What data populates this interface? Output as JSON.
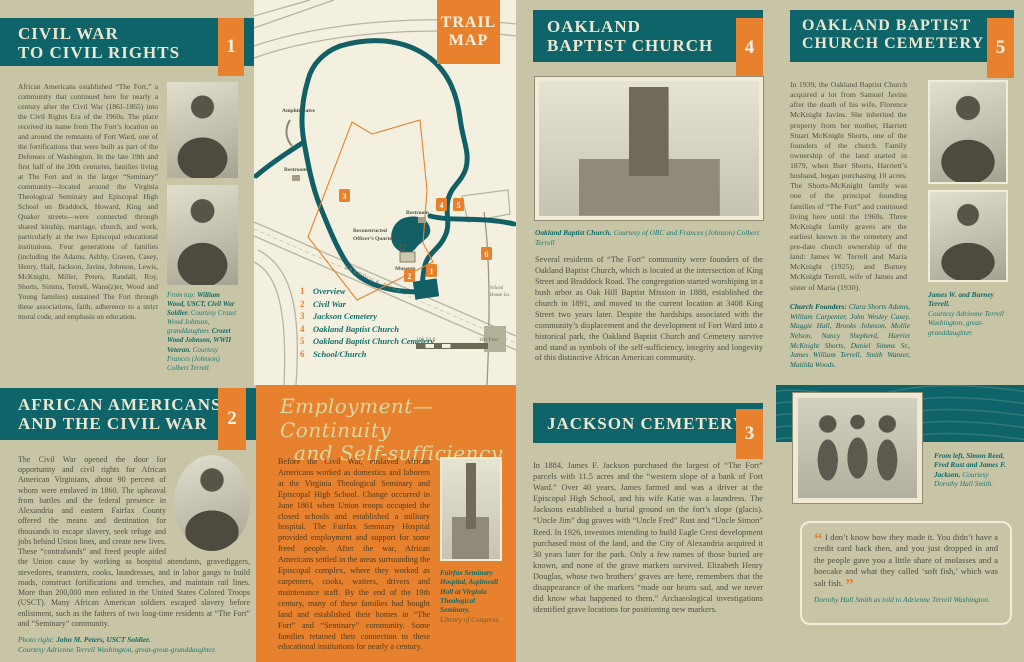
{
  "colors": {
    "teal": "#0e6468",
    "orange": "#e8812e",
    "olive": "#c8c5a6",
    "cream": "#f4f0e0"
  },
  "panel1": {
    "title1": "CIVIL WAR",
    "title2": "TO CIVIL RIGHTS",
    "number": "1",
    "body": "African Americans established “The Fort,” a community that continued here for nearly a century after the Civil War (1861-1865) into the Civil Rights Era of the 1960s. The place received its name from The Fort’s location on and around the remnants of Fort Ward, one of the fortifications that were built as part of the Defenses of Washington. In the late 19th and first half of the 20th centuries, families living at The Fort and in the larger “Seminary” community—located around the Virginia Theological Seminary and Episcopal High School on Braddock, Howard, King and Quaker streets—were connected through shared kinship, marriage, church, and work, particularly at the two Episcopal educational institutions. Four generations of families (including the Adams, Ashby, Craven, Casey, Henry, Hall, Jackson, Javins, Johnson, Lewis, McKnight, Miller, Peters, Randall, Roy, Shorts, Simms, Terrell, Wans(z)er, Wood and Young families) sustained The Fort through these associations, faith, adherence to a strict moral code, and emphasis on education.",
    "caption": {
      "intro": "From top: ",
      "name1": "William Wood, USCT, Civil War Soldier.",
      "credit1": "Courtesy Crozet Wood Johnson, granddaughter.",
      "name2": "Crozet Wood Johnson, WWII Veteran.",
      "credit2": "Courtesy Frances (Johnson) Colbert Terrell."
    }
  },
  "trail_map": {
    "title1": "TRAIL",
    "title2": "MAP",
    "labels": {
      "amphitheatre": "Amphitheatre",
      "restroom_a": "Restroom",
      "restroom_b": "Restroom",
      "oq1": "Reconstructed",
      "oq2": "Officer’s Quarters",
      "museum": "Museum",
      "road": "BRADDOCK ROAD",
      "lane1": "School",
      "lane2": "House Ln."
    },
    "legend": [
      {
        "num": "1",
        "label": "Overview"
      },
      {
        "num": "2",
        "label": "Civil War"
      },
      {
        "num": "3",
        "label": "Jackson Cemetery"
      },
      {
        "num": "4",
        "label": "Oakland Baptist Church"
      },
      {
        "num": "5",
        "label": "Oakland Baptist Church Cemetery"
      },
      {
        "num": "6",
        "label": "School/Church"
      }
    ],
    "scale_left": "100  50  0",
    "scale_right": "100 Feet"
  },
  "panel4": {
    "title1": "OAKLAND",
    "title2": "BAPTIST CHURCH",
    "number": "4",
    "caption": {
      "name": "Oakland Baptist Church.",
      "credit": "Courtesy of OBC and Frances (Johnson) Colbert Terrell"
    },
    "body": "Several residents of “The Fort” community were founders of the Oakland Baptist Church, which is located at the intersection of King Street and Braddock Road. The congregation started worshiping in a bush arbor as Oak Hill Baptist Mission in 1888, established the church in 1891, and moved to the current location at 3408 King Street two years later. Despite the hardships associated with the community’s displacement and the development of Fort Ward into a historical park, the Oakland Baptist Church and Cemetery survive and stand as symbols of the self-sufficiency, integrity and longevity of this distinctive African American community."
  },
  "panel5": {
    "title1": "OAKLAND BAPTIST",
    "title2": "CHURCH CEMETERY",
    "number": "5",
    "body": "In 1939, the Oakland Baptist Church acquired a lot from Samuel Javins after the death of his wife, Florence McKnight Javins. She inherited the property from her mother, Harriett Stuart McKnight Shorts, one of the founders of the church. Family ownership of the land started in 1879, when Burr Shorts, Harriett’s husband, began purchasing 10 acres. The Shorts-McKnight family was one of the principal founding families of “The Fort” and continued living here until the 1960s. Three McKnight family graves are the earliest known in the cemetery and pre-date church ownership of the land: James W. Terrell and Maria McKnight (1925); and Burney McKnight Terrell, wife of James and sister of Maria (1930).",
    "founders_label": "Church Founders:",
    "founders": "Clara Shorts Adams, William Carpenter, John Wesley Casey, Maggie Hall, Brooks Johnson, Mollie Nelson, Nancy Shepherd, Harriet McKnight Shorts, Daniel Simms Sr., James William Terrell, Smith Wanzer, Matilda Woods.",
    "caption": {
      "name": "James W. and Burney Terrell.",
      "credit": "Courtesy Adrienne Terrell Washington, great-granddaughter."
    }
  },
  "panel2": {
    "title1": "AFRICAN AMERICANS",
    "title2": "AND THE CIVIL WAR",
    "number": "2",
    "body": "The Civil War opened the door for opportunity and civil rights for African American Virginians, about 90 percent of whom were enslaved in 1860. The upheaval from battles and the federal presence in Alexandria and eastern Fairfax County offered the means and destination for thousands to escape slavery, seek refuge and jobs behind Union lines, and create new lives. These “contrabands” and freed people aided the Union cause by working as hospital attendants, gravediggers, stevedores, teamsters, cooks, laundresses, and in labor gangs to build roads, construct fortifications and trenches, and maintain rail lines. More than 200,000 men enlisted in the United States Colored Troops (USCT). Many African American soldiers escaped slavery before enlistment, such as the fathers of two long-time residents at “The Fort” and “Seminary” community.",
    "caption": {
      "intro": "Photo right: ",
      "name": "John M. Peters, USCT Soldier.",
      "credit": "Courtesy Adrienne Terrell Washington, great-great-granddaughter."
    }
  },
  "employment": {
    "title1": "Employment—Continuity",
    "title2": "and Self-sufficiency",
    "body": "Before the Civil War, enslaved African Americans worked as domestics and laborers at the Virginia Theological Seminary and Episcopal High School. Change occurred in June 1861 when Union troops occupied the closed schools and established a military hospital. The Fairfax Seminary Hospital provided employment and support for some freed people. After the war, African Americans settled in the areas surrounding the Episcopal complex, where they worked as carpenters, cooks, waiters, drivers and maintenance staff. By the end of the 19th century, many of these families had bought land and established their homes in “The Fort” and “Seminary” community. Some families retained their connection to these educational institutions for nearly a century.",
    "caption": {
      "name": "Fairfax Seminary Hospital, Aspinwall Hall at Virginia Theological Seminary.",
      "credit": "Library of Congress."
    }
  },
  "panel3": {
    "title": "JACKSON CEMETERY",
    "number": "3",
    "body": "In 1884, James F. Jackson purchased the largest of “The Fort” parcels with 11.5 acres and the “western slope of a bank of Fort Ward.” Over 40 years, James farmed and was a driver at the Episcopal High School, and his wife Katie was a laundress. The Jacksons established a burial ground on the fort’s slope (glacis). “Uncle Jim” dug graves with “Uncle Fred” Rust and “Uncle Simon” Reed. In 1926, investors intending to build Eagle Crest development purchased most of the land, and the City of Alexandria acquired it 30 years later for the park. Only a few names of those buried are known, and none of the grave markers survived. Elizabeth Henry Douglas, whose two brothers’ graves are here, remembers that the disappearance of the markers “made our hearts sad, and we never did know what happened to them.” Archaeological investigations identified grave locations for positioning new markers."
  },
  "quote_panel": {
    "caption": {
      "name": "From left, Simon Reed, Fred Rust and James F. Jackson.",
      "credit": "Courtesy Dorothy Hall Smith."
    },
    "quote": {
      "open": "“",
      "text": "I don’t know how they made it. You didn’t have a credit card back then, and you just dropped in and the people gave you a little share of molasses and a hoecake and what they called ‘soft fish,’ which was salt fish.",
      "close": "”",
      "attribution": "Dorothy Hall Smith as told to Adrienne Terrell Washington."
    }
  }
}
